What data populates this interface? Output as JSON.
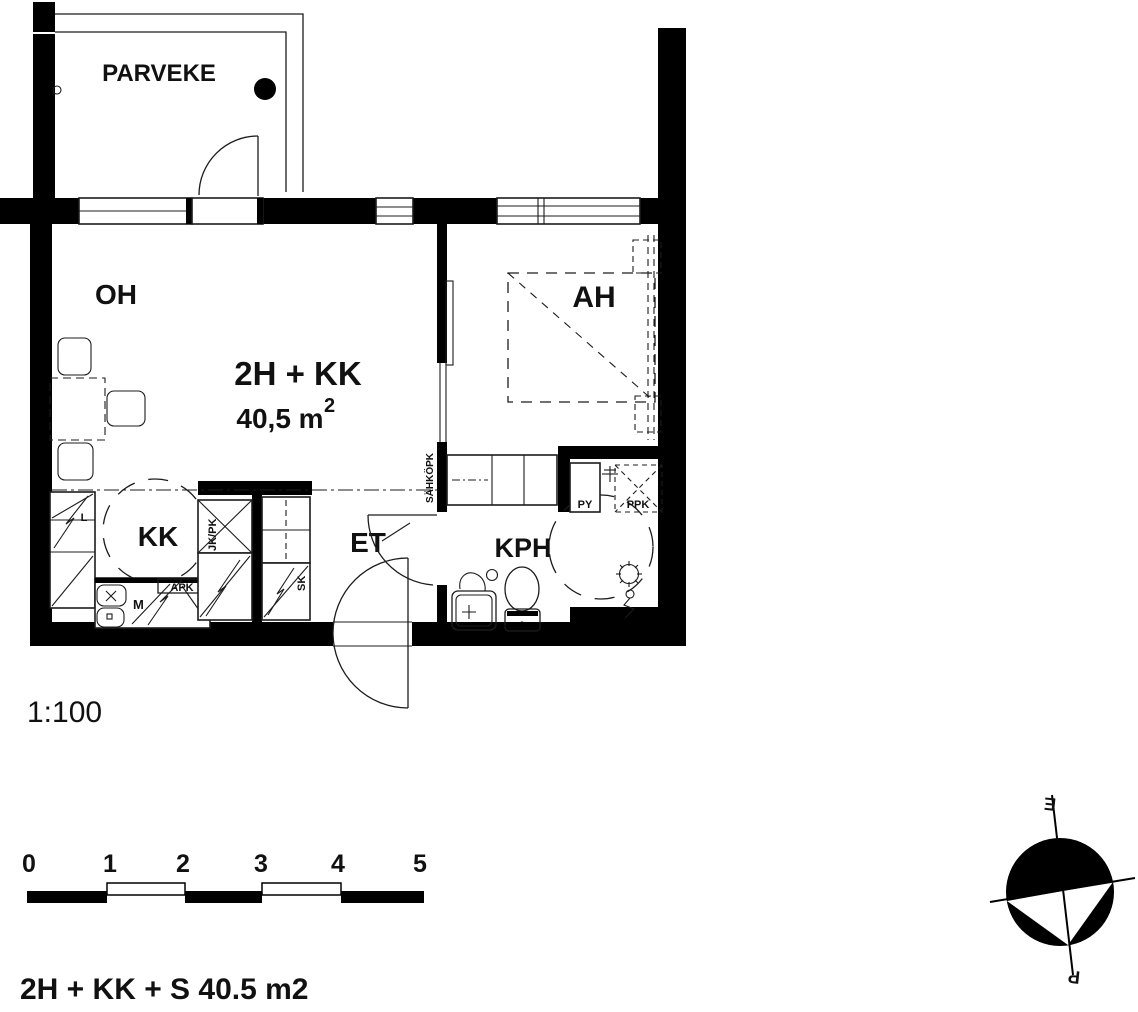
{
  "floor_plan": {
    "apartment_title": "2H + KK",
    "area_value": "40,5 m",
    "area_superscript": "2",
    "rooms": {
      "balcony": "PARVEKE",
      "living_room": "OH",
      "bedroom": "AH",
      "kitchenette": "KK",
      "hallway": "ET",
      "bathroom": "KPH"
    },
    "fixtures": {
      "stove": "L",
      "fridge_freezer": "JK/PK",
      "dishwasher": "APK",
      "sink_unit": "M",
      "cleaning_closet": "SK",
      "electrical_panel": "SÄHKÖPK",
      "basin_cabinet": "PY",
      "washing_machine": "PPK"
    },
    "scale": {
      "label": "1:100",
      "ticks": [
        "0",
        "1",
        "2",
        "3",
        "4",
        "5"
      ]
    },
    "footer_label": "2H + KK + S  40.5 m2",
    "compass": {
      "north": "P",
      "south": "E"
    }
  }
}
